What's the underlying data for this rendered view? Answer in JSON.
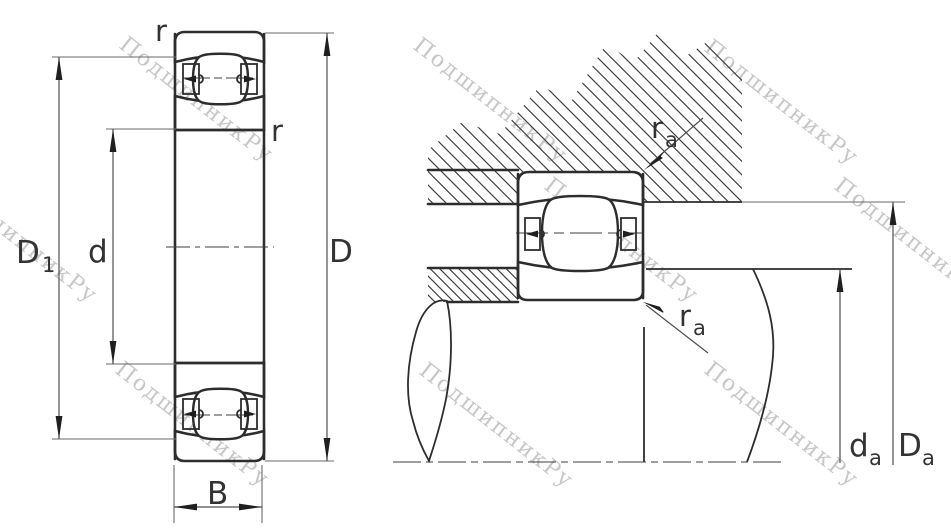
{
  "watermark": {
    "text": "ПодшипникРу",
    "color": "#c7c7c7"
  },
  "colors": {
    "line": "#2d2d2d",
    "dimension_line": "#4f4f4f",
    "label": "#333333",
    "background": "#ffffff"
  },
  "front_view": {
    "labels": {
      "r_top": "r",
      "r_inner": "r",
      "D1_main": "D",
      "D1_sub": "1",
      "bore_diameter": "d",
      "outer_diameter": "D",
      "width": "B"
    }
  },
  "mounted_view": {
    "labels": {
      "ra_top_main": "r",
      "ra_top_sub": "a",
      "ra_bottom_main": "r",
      "ra_bottom_sub": "a",
      "da_main": "d",
      "da_sub": "a",
      "Da_main": "D",
      "Da_sub": "a"
    }
  }
}
